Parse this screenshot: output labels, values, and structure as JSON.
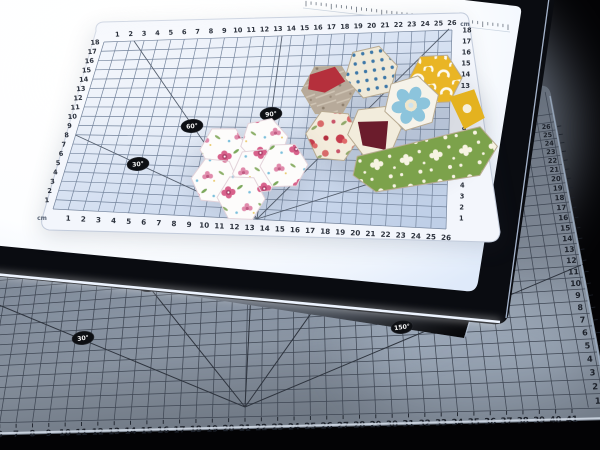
{
  "scene": {
    "description": "LED light pad with transparent cm grid ruler mat, fabric hexagon patches, on a large cutting mat",
    "background_color": "#030305"
  },
  "top_mat": {
    "unit_label": "cm",
    "top_scale": [
      "1",
      "2",
      "3",
      "4",
      "5",
      "6",
      "7",
      "8",
      "9",
      "10",
      "11",
      "12",
      "13",
      "14",
      "15",
      "16",
      "17",
      "18",
      "19",
      "20",
      "21",
      "22",
      "23",
      "24",
      "25",
      "26"
    ],
    "bottom_scale": [
      "1",
      "2",
      "3",
      "4",
      "5",
      "6",
      "7",
      "8",
      "9",
      "10",
      "11",
      "12",
      "13",
      "14",
      "15",
      "16",
      "17",
      "18",
      "19",
      "20",
      "21",
      "22",
      "23",
      "24",
      "25",
      "26"
    ],
    "left_scale": [
      "1",
      "2",
      "3",
      "4",
      "5",
      "6",
      "7",
      "8",
      "9",
      "10",
      "11",
      "12",
      "13",
      "14",
      "15",
      "16",
      "17",
      "18"
    ],
    "right_scale": [
      "1",
      "2",
      "3",
      "4",
      "5",
      "6",
      "7",
      "8",
      "9",
      "10",
      "11",
      "12",
      "13",
      "14",
      "15",
      "16",
      "17",
      "18"
    ],
    "angle_labels": [
      "30°",
      "60°",
      "90°",
      "120°",
      "150°"
    ],
    "colors": {
      "surface": "#ccd9ec",
      "margin": "#f3f6fc",
      "grid": "#74849c",
      "text": "#2b313c",
      "angle_line": "#555f6e",
      "badge": "#0d0f13",
      "badge_text": "#f2f2f2"
    }
  },
  "bottom_mat": {
    "bottom_scale": [
      "6",
      "7",
      "8",
      "9",
      "10",
      "11",
      "12",
      "13",
      "14",
      "15",
      "16",
      "17",
      "18",
      "19",
      "20",
      "21",
      "22",
      "23",
      "24",
      "25",
      "26",
      "27",
      "28",
      "29",
      "30",
      "31",
      "32",
      "33",
      "34",
      "35",
      "36",
      "37",
      "38",
      "39",
      "40",
      "41"
    ],
    "right_scale": [
      "1",
      "2",
      "3",
      "4",
      "5",
      "6",
      "7",
      "8",
      "9",
      "10",
      "11",
      "12",
      "13",
      "14",
      "15",
      "16",
      "17",
      "18",
      "19",
      "20",
      "21",
      "22",
      "23",
      "24",
      "25",
      "26"
    ],
    "angle_labels": [
      "30°",
      "60°",
      "150°"
    ],
    "colors": {
      "surface": "#79828f",
      "grid": "#3f4754",
      "text": "#1c212a",
      "edge_highlight": "#d5deea",
      "badge": "#0d0f13",
      "badge_text": "#f2f2f2"
    }
  },
  "light_pad": {
    "colors": {
      "surface": "#ffffff",
      "tint": "#e9f1fc",
      "frame": "#0a0c11",
      "edge_glow": "#e8f1ff",
      "ruler_tick": "#4e5866"
    }
  },
  "fabric": {
    "clusters": [
      {
        "name": "pink-floral-hexagon-flower",
        "fabrics": [
          "white with pink flowers",
          "green leaves",
          "blue dots"
        ]
      },
      {
        "name": "multicolor-hexagon-patchwork",
        "fabrics": [
          "cream blue polka dot",
          "red floral",
          "taupe",
          "maroon",
          "white blue petal flower",
          "yellow white curls",
          "olive green white floral",
          "yellow"
        ]
      }
    ]
  }
}
